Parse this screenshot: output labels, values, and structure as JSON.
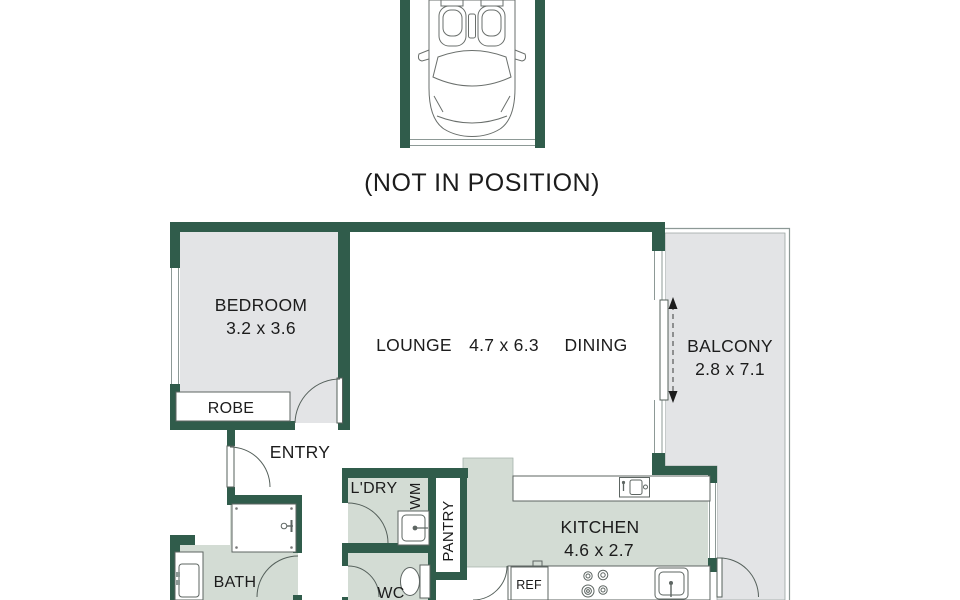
{
  "note": "(NOT IN POSITION)",
  "rooms": {
    "bedroom": {
      "label": "BEDROOM",
      "dims": "3.2 x 3.6"
    },
    "lounge": {
      "label": "LOUNGE"
    },
    "lounge_dining_dims": "4.7 x 6.3",
    "dining": {
      "label": "DINING"
    },
    "balcony": {
      "label": "BALCONY",
      "dims": "2.8 x 7.1"
    },
    "kitchen": {
      "label": "KITCHEN",
      "dims": "4.6 x 2.7"
    },
    "bath": {
      "label": "BATH"
    },
    "wc": {
      "label": "WC"
    },
    "laundry": {
      "label": "L'DRY"
    },
    "entry": {
      "label": "ENTRY"
    },
    "robe": {
      "label": "ROBE"
    },
    "pantry": {
      "label": "PANTRY"
    }
  },
  "fixtures": {
    "washing_machine": "WM",
    "refrigerator": "REF"
  },
  "colors": {
    "wall_green": "#305c4b",
    "floor_light_gray": "#e3e4e6",
    "floor_wet_area": "#d3dcd4",
    "outline_gray": "#8d9996"
  }
}
